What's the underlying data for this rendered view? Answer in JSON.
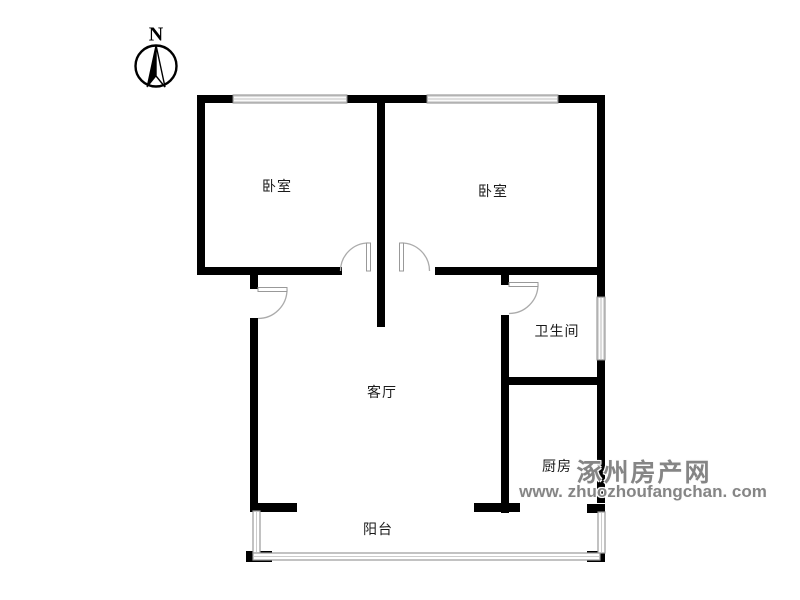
{
  "compass": {
    "label": "N"
  },
  "rooms": {
    "bedroom_left": "卧室",
    "bedroom_right": "卧室",
    "bathroom": "卫生间",
    "living_room": "客厅",
    "kitchen": "厨房",
    "balcony": "阳台"
  },
  "watermark": {
    "site_name": "涿州房产网",
    "url": "www. zhuozhoufangchan. com"
  },
  "colors": {
    "wall": "#000000",
    "background": "#ffffff",
    "window_fill": "#d9d9d9",
    "window_border": "#8a8a8a",
    "door_leaf": "#999999",
    "door_arc": "#ababab",
    "balcony_rail": "#9a9a9a",
    "watermark_text": "#858585",
    "label_text": "#1a1a1a"
  }
}
